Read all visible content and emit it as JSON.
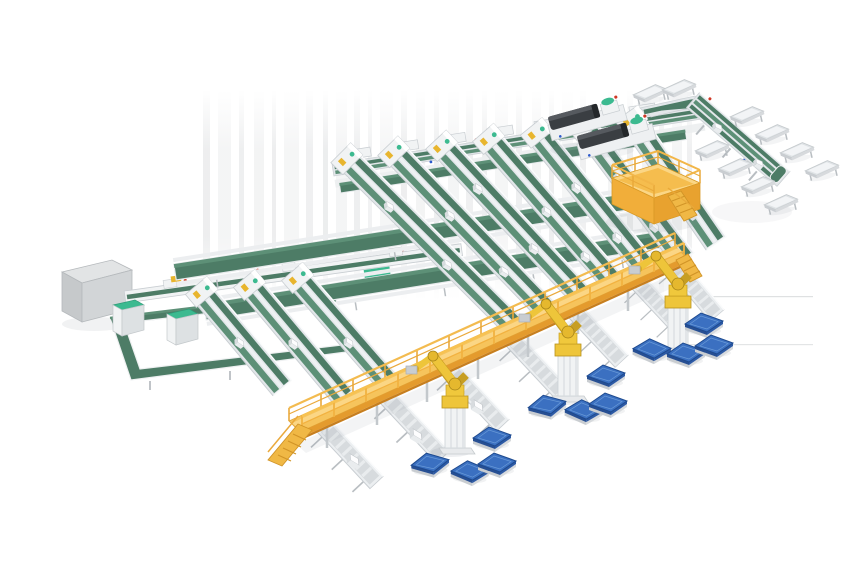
{
  "scene": {
    "type": "isometric-3d-render",
    "subject": "Automated conveyor sorting and robotic palletizing system",
    "background_color": "#ffffff"
  },
  "palette": {
    "conveyor_belt_green": "#4d7c66",
    "belt_highlight_green": "#5d9077",
    "accent_teal": "#3cba90",
    "frame_white": "#f1f3f4",
    "frame_light": "#e3e7ea",
    "frame_gray": "#c9ced2",
    "leg_gray": "#b9bec2",
    "walkway_yellow": "#f6c45c",
    "walkway_yellow_light": "#fbd685",
    "walkway_orange": "#e49b2d",
    "walkway_rail": "#f2b648",
    "robot_yellow": "#eec53a",
    "robot_yellow_dark": "#c79e22",
    "pallet_blue": "#3b70c1",
    "pallet_blue_dark": "#274f93",
    "pallet_blue_side": "#2d5aa5",
    "machine_dark": "#3a3e42",
    "machine_dark_top": "#565a5f",
    "cabinet_gray": "#d2d5d7",
    "accent_red": "#cf3826",
    "accent_blue": "#2d5acc",
    "shadow_gray": "#8a93a0",
    "streak_gray": "#d8dadc"
  },
  "components": {
    "sorting_lanes": {
      "count": 10
    },
    "cross_spine_conveyors": {
      "count": 3
    },
    "infeed_spine_conveyors": {
      "count": 2
    },
    "buffer_loop": {
      "count": 1
    },
    "loop_cabinets": {
      "count": 2
    },
    "electrical_cabinet": {
      "count": 1
    },
    "dark_process_machines": {
      "count": 2
    },
    "operator_platform": {
      "count": 1
    },
    "elevated_walkway": {
      "count": 1
    },
    "discharge_conveyors": {
      "count": 7
    },
    "palletizing_robots": {
      "count": 3
    },
    "pallets": {
      "count": 12
    },
    "pack_chutes": {
      "count": 10
    },
    "right_branch_line": {
      "count": 1
    }
  }
}
